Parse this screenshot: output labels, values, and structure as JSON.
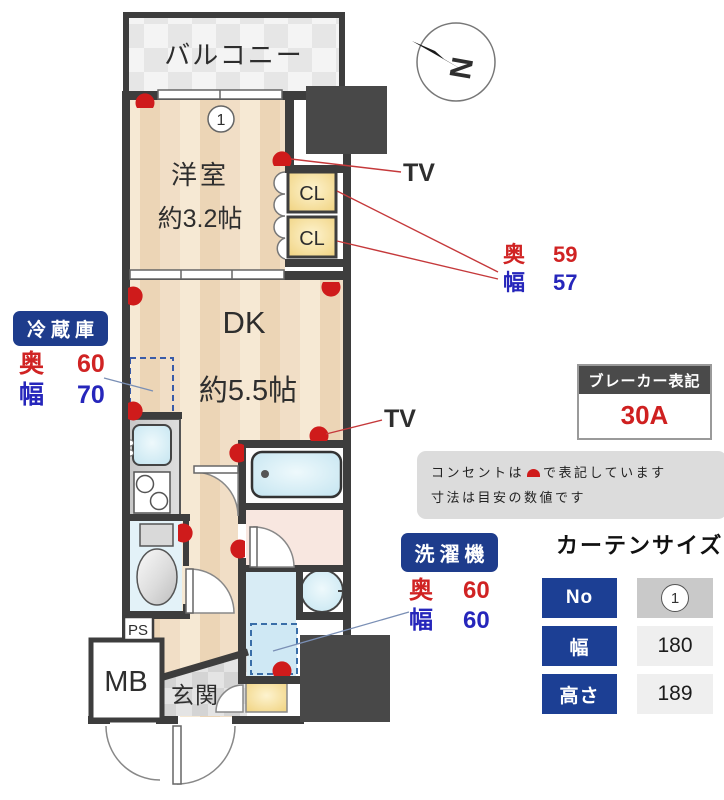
{
  "colors": {
    "wall": "#3d3d3d",
    "label_blue": "#1e3c8c",
    "dim_red": "#d02323",
    "dim_blue": "#2626bb",
    "outlet_red": "#cf1b1b",
    "floor_beige": "#eedcc2",
    "water_blue": "#cfeaf3",
    "closet_yellow": "#f3d98e"
  },
  "plan": {
    "balcony": "バルコニー",
    "western_room": {
      "name": "洋室",
      "size": "約3.2帖",
      "number": "1"
    },
    "dk": {
      "name": "DK",
      "size": "約5.5帖"
    },
    "closet_top": "CL",
    "closet_bottom": "CL",
    "entrance": "玄関",
    "meter_box": "MB",
    "pipe_space": "PS",
    "tv_upper": "TV",
    "tv_lower": "TV",
    "compass_north": "N"
  },
  "callouts": {
    "closet_dims": {
      "rows": [
        {
          "label": "奥",
          "value": "59"
        },
        {
          "label": "幅",
          "value": "57"
        }
      ]
    },
    "fridge": {
      "title": "冷蔵庫",
      "rows": [
        {
          "label": "奥",
          "value": "60"
        },
        {
          "label": "幅",
          "value": "70"
        }
      ]
    },
    "washer": {
      "title": "洗濯機",
      "rows": [
        {
          "label": "奥",
          "value": "60"
        },
        {
          "label": "幅",
          "value": "60"
        }
      ]
    },
    "breaker": {
      "title": "ブレーカー表記",
      "value": "30A"
    },
    "note": {
      "line1_prefix": "コンセントは",
      "line1_suffix": "で表記しています",
      "line2": "寸法は目安の数値です"
    },
    "curtain": {
      "title": "カーテンサイズ",
      "rows": [
        {
          "label": "No",
          "value": "1"
        },
        {
          "label": "幅",
          "value": "180"
        },
        {
          "label": "高さ",
          "value": "189"
        }
      ]
    }
  }
}
